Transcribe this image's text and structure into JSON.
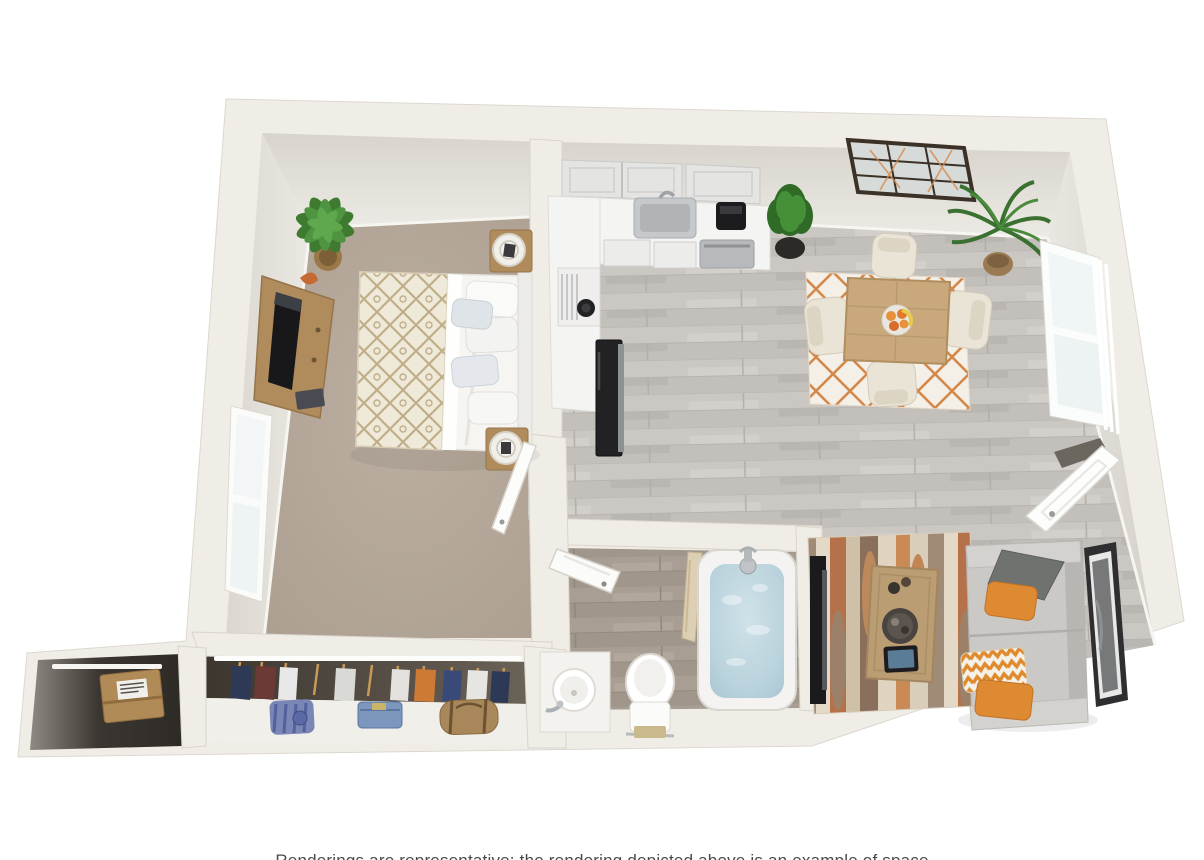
{
  "meta": {
    "title": "3D apartment floor plan rendering",
    "text_labels_visible": false
  },
  "caption": {
    "text": "Renderings are representative; the rendering depicted above is an example of space",
    "partially_cut_off": true
  },
  "palette": {
    "background": "#ffffff",
    "wall_top": "#f0ede7",
    "wall_face": "#e2ded7",
    "bedroom_carpet": "#b4a79a",
    "wood_floor": "#c8c4bf",
    "bathroom_floor": "#a89e93",
    "counter_white": "#f4f4f2",
    "accent_orange": "#d98a3e",
    "sofa_gray": "#cac8c4",
    "tub_water": "#b9d2dc",
    "plant_green": "#4d8a3b",
    "wood_furniture": "#b08c5c"
  },
  "scene": {
    "rooms": [
      {
        "name": "bedroom",
        "floor": "tan carpet",
        "furniture": [
          "queen bed with lattice-pattern duvet and pillows",
          "upholstered headboard",
          "two wood nightstands with drum lamps",
          "wood media console with flat-screen TV",
          "potted plant",
          "double-pane window on left wall",
          "white door opening from kitchen wall"
        ]
      },
      {
        "name": "kitchen",
        "floor": "gray wood plank",
        "furniture": [
          "L-shaped white counter",
          "upper cabinets",
          "stainless sink with faucet",
          "black coffee maker",
          "stainless dishwasher",
          "white range with cooktop and vent hood",
          "black refrigerator",
          "potted shrub in black planter"
        ]
      },
      {
        "name": "dining-area",
        "floor": "gray wood plank",
        "furniture": [
          "black grid wall mirror",
          "square wood dining table",
          "four cream upholstered chairs",
          "fruit bowl with oranges and bananas",
          "white rug with orange lattice",
          "palm plant",
          "tall window with vertical blinds",
          "white entry door on right wall"
        ]
      },
      {
        "name": "living-area",
        "floor": "gray wood plank",
        "furniture": [
          "gray two-cushion sofa",
          "gray pillow",
          "two solid orange pillows",
          "orange chevron pillow",
          "wood coffee table with round tray and tablet",
          "multicolor striped area rug",
          "leaning framed artwork",
          "flat-screen TV on wall side"
        ]
      },
      {
        "name": "bathroom",
        "floor": "dark wood plank",
        "furniture": [
          "white door opening inward",
          "soaking tub filled with water",
          "chrome tub faucet",
          "shower curtain",
          "white vanity with round sink",
          "toilet with towel bar"
        ]
      },
      {
        "name": "closet",
        "floor": "brown carpet",
        "furniture": [
          "hanging clothes on rod",
          "white shelf",
          "folded striped shirt",
          "folded jeans",
          "tan duffel bag"
        ]
      },
      {
        "name": "storage-closet",
        "floor": "dark interior",
        "furniture": [
          "cardboard box with shipping label",
          "white shelf"
        ]
      }
    ]
  }
}
